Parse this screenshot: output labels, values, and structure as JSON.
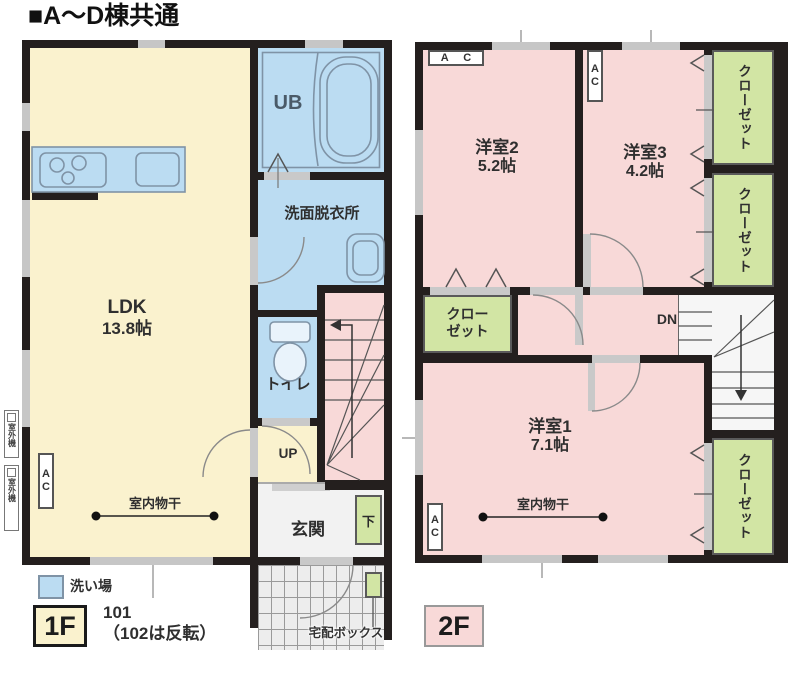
{
  "title": "■A～D棟共通",
  "common": {
    "ac_vertical": "AC",
    "ac_horizontal": "A C",
    "indoor_drying": "室内物干"
  },
  "floor1": {
    "tag": "1F",
    "unit": "101",
    "unit_note": "（102は反転）",
    "ldk": "LDK",
    "ldk_size": "13.8帖",
    "ub": "UB",
    "washroom": "洗面脱衣所",
    "toilet": "トイレ",
    "entrance": "玄関",
    "up": "UP",
    "shoe": "下",
    "outdoor_unit": "室外機",
    "wash_area": "洗い場",
    "delivery_box": "宅配ボックス"
  },
  "floor2": {
    "tag": "2F",
    "room1": "洋室1",
    "room1_size": "7.1帖",
    "room2": "洋室2",
    "room2_size": "5.2帖",
    "room3": "洋室3",
    "room3_size": "4.2帖",
    "closet": "クローゼット",
    "closet_two_line": "クロー\nゼット",
    "down": "DN"
  }
}
